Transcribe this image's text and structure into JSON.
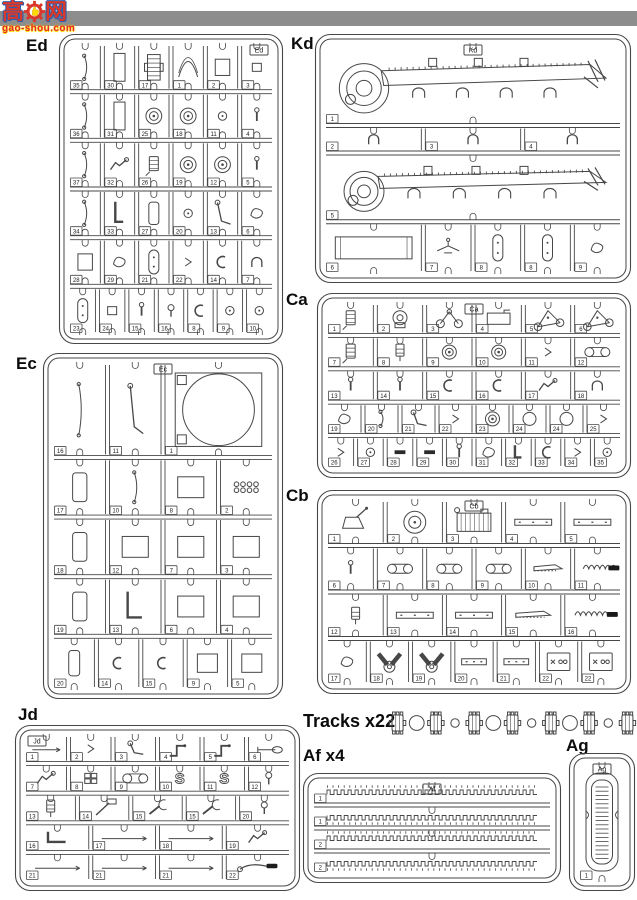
{
  "colors": {
    "topbar": "#8d8d8d",
    "line": "#474747",
    "logo_red": "#d8392b",
    "logo_blue": "#2b5fb0",
    "logo_yellow": "#ffd900"
  },
  "logo": {
    "char_left": "高",
    "char_right": "网",
    "domain": "gao-shou.com"
  },
  "tracks": {
    "label": "Tracks x22",
    "items": [
      "link",
      "big",
      "link",
      "small",
      "link",
      "big",
      "link",
      "small",
      "link",
      "big",
      "link",
      "small",
      "link"
    ]
  },
  "sprues": [
    {
      "id": "ed",
      "label": "Ed",
      "tag": "Ed",
      "tag_pos": "tr",
      "rows": [
        {
          "cells": [
            {
              "n": "35",
              "g": "rod"
            },
            {
              "n": "30",
              "g": "tallrect"
            },
            {
              "n": "17",
              "g": "grill"
            },
            {
              "n": "1",
              "g": "arc"
            },
            {
              "n": "2",
              "g": "rect"
            },
            {
              "n": "3",
              "g": "sq"
            }
          ]
        },
        {
          "cells": [
            {
              "n": "36",
              "g": "rod"
            },
            {
              "n": "31",
              "g": "tallrect"
            },
            {
              "n": "25",
              "g": "wheel"
            },
            {
              "n": "18",
              "g": "wheel"
            },
            {
              "n": "11",
              "g": "smallcircle"
            },
            {
              "n": "4",
              "g": "bolt"
            }
          ]
        },
        {
          "cells": [
            {
              "n": "37",
              "g": "rod"
            },
            {
              "n": "32",
              "g": "tool"
            },
            {
              "n": "26",
              "g": "cylinder"
            },
            {
              "n": "19",
              "g": "wheel"
            },
            {
              "n": "12",
              "g": "wheel"
            },
            {
              "n": "5",
              "g": "bolt"
            }
          ]
        },
        {
          "cells": [
            {
              "n": "34",
              "g": "rod"
            },
            {
              "n": "33",
              "g": "pipe"
            },
            {
              "n": "27",
              "g": "pad"
            },
            {
              "n": "20",
              "g": "smallcircle"
            },
            {
              "n": "13",
              "g": "lever"
            },
            {
              "n": "6",
              "g": "blob"
            }
          ]
        },
        {
          "cells": [
            {
              "n": "28",
              "g": "rect"
            },
            {
              "n": "29",
              "g": "blob"
            },
            {
              "n": "21",
              "g": "oval"
            },
            {
              "n": "22",
              "g": "tiny"
            },
            {
              "n": "14",
              "g": "clip"
            },
            {
              "n": "7",
              "g": "bracket"
            }
          ]
        },
        {
          "cells": [
            {
              "n": "23",
              "g": "oval"
            },
            {
              "n": "24",
              "g": "sq"
            },
            {
              "n": "15",
              "g": "bolt"
            },
            {
              "n": "16",
              "g": "bulb"
            },
            {
              "n": "8",
              "g": "clip"
            },
            {
              "n": "9",
              "g": "smallcircle"
            },
            {
              "n": "10",
              "g": "smallcircle"
            }
          ]
        }
      ]
    },
    {
      "id": "kd",
      "label": "Kd",
      "tag": "Kd",
      "tag_pos": "tc",
      "rows": [
        {
          "h": 1.5,
          "cells": [
            {
              "n": "1",
              "g": "fender"
            }
          ]
        },
        {
          "h": 0.5,
          "cells": [
            {
              "n": "2",
              "g": "bracket"
            },
            {
              "n": "3",
              "g": "bracket"
            },
            {
              "n": "4",
              "g": "bracket"
            }
          ]
        },
        {
          "h": 1.25,
          "cells": [
            {
              "n": "5",
              "g": "fender"
            }
          ]
        },
        {
          "h": 0.95,
          "cells": [
            {
              "n": "6",
              "g": "longrect",
              "s": 2
            },
            {
              "n": "7",
              "g": "plane"
            },
            {
              "n": "8",
              "g": "oval"
            },
            {
              "n": "8",
              "g": "oval"
            },
            {
              "n": "9",
              "g": "blob"
            }
          ]
        }
      ]
    },
    {
      "id": "ec",
      "label": "Ec",
      "tag": "Ec",
      "tag_pos": "tc",
      "rows": [
        {
          "h": 1.6,
          "cells": [
            {
              "n": "16",
              "g": "rod"
            },
            {
              "n": "11",
              "g": "lever"
            },
            {
              "n": "1",
              "g": "bigcircle",
              "s": 2
            }
          ]
        },
        {
          "h": 1,
          "cells": [
            {
              "n": "17",
              "g": "pad"
            },
            {
              "n": "10",
              "g": "rod"
            },
            {
              "n": "8",
              "g": "rect"
            },
            {
              "n": "2",
              "g": "grid8"
            }
          ]
        },
        {
          "h": 1,
          "cells": [
            {
              "n": "18",
              "g": "pad"
            },
            {
              "n": "12",
              "g": "rect"
            },
            {
              "n": "7",
              "g": "rect"
            },
            {
              "n": "3",
              "g": "rect"
            }
          ]
        },
        {
          "h": 1,
          "cells": [
            {
              "n": "19",
              "g": "pad"
            },
            {
              "n": "13",
              "g": "pipe"
            },
            {
              "n": "6",
              "g": "rect"
            },
            {
              "n": "4",
              "g": "rect"
            }
          ]
        },
        {
          "h": 0.9,
          "cells": [
            {
              "n": "20",
              "g": "pad"
            },
            {
              "n": "14",
              "g": "clip"
            },
            {
              "n": "15",
              "g": "clip"
            },
            {
              "n": "9",
              "g": "rect"
            },
            {
              "n": "5",
              "g": "rect"
            }
          ]
        }
      ]
    },
    {
      "id": "ca",
      "label": "Ca",
      "tag": "Ca",
      "tag_pos": "tc",
      "rows": [
        {
          "cells": [
            {
              "n": "1",
              "g": "cylinder"
            },
            {
              "n": "2",
              "g": "pump"
            },
            {
              "n": "3",
              "g": "axle"
            },
            {
              "n": "4",
              "g": "box"
            },
            {
              "n": "5",
              "g": "arm"
            },
            {
              "n": "6",
              "g": "arm"
            }
          ]
        },
        {
          "cells": [
            {
              "n": "7",
              "g": "cylinder"
            },
            {
              "n": "8",
              "g": "jack"
            },
            {
              "n": "9",
              "g": "wheel"
            },
            {
              "n": "10",
              "g": "wheel"
            },
            {
              "n": "11",
              "g": "tiny"
            },
            {
              "n": "12",
              "g": "links"
            }
          ]
        },
        {
          "cells": [
            {
              "n": "13",
              "g": "bolt"
            },
            {
              "n": "14",
              "g": "bolt"
            },
            {
              "n": "15",
              "g": "clip"
            },
            {
              "n": "16",
              "g": "clip"
            },
            {
              "n": "17",
              "g": "tool"
            },
            {
              "n": "18",
              "g": "bracket"
            }
          ]
        },
        {
          "cells": [
            {
              "n": "19",
              "g": "blob"
            },
            {
              "n": "20",
              "g": "rod"
            },
            {
              "n": "21",
              "g": "lever"
            },
            {
              "n": "22",
              "g": "tiny"
            },
            {
              "n": "23",
              "g": "wheel"
            },
            {
              "n": "24",
              "g": "circle"
            },
            {
              "n": "24",
              "g": "circle"
            },
            {
              "n": "25",
              "g": "tiny"
            }
          ]
        },
        {
          "cells": [
            {
              "n": "26",
              "g": "tiny"
            },
            {
              "n": "27",
              "g": "smallcircle"
            },
            {
              "n": "28",
              "g": "bar"
            },
            {
              "n": "29",
              "g": "bar"
            },
            {
              "n": "30",
              "g": "bolt"
            },
            {
              "n": "31",
              "g": "blob"
            },
            {
              "n": "32",
              "g": "pipe"
            },
            {
              "n": "33",
              "g": "clip"
            },
            {
              "n": "34",
              "g": "tiny"
            },
            {
              "n": "35",
              "g": "smallcircle"
            }
          ]
        }
      ]
    },
    {
      "id": "cb",
      "label": "Cb",
      "tag": "Cb",
      "tag_pos": "tc",
      "rows": [
        {
          "cells": [
            {
              "n": "1",
              "g": "bucket"
            },
            {
              "n": "2",
              "g": "wheel"
            },
            {
              "n": "3",
              "g": "engine"
            },
            {
              "n": "4",
              "g": "plate"
            },
            {
              "n": "5",
              "g": "plate"
            }
          ]
        },
        {
          "cells": [
            {
              "n": "6",
              "g": "bolt"
            },
            {
              "n": "7",
              "g": "links"
            },
            {
              "n": "8",
              "g": "links"
            },
            {
              "n": "9",
              "g": "links"
            },
            {
              "n": "10",
              "g": "saw"
            },
            {
              "n": "11",
              "g": "blacksaw"
            }
          ]
        },
        {
          "cells": [
            {
              "n": "12",
              "g": "jack"
            },
            {
              "n": "13",
              "g": "plate"
            },
            {
              "n": "14",
              "g": "plate"
            },
            {
              "n": "15",
              "g": "saw"
            },
            {
              "n": "16",
              "g": "blacksaw"
            }
          ]
        },
        {
          "cells": [
            {
              "n": "17",
              "g": "blob"
            },
            {
              "n": "18",
              "g": "vee"
            },
            {
              "n": "19",
              "g": "vee"
            },
            {
              "n": "20",
              "g": "plate"
            },
            {
              "n": "21",
              "g": "plate"
            },
            {
              "n": "22",
              "g": "x3"
            },
            {
              "n": "22",
              "g": "x3"
            }
          ]
        }
      ]
    },
    {
      "id": "jd",
      "label": "Jd",
      "tag": "Jd",
      "tag_pos": "tl",
      "rows": [
        {
          "cells": [
            {
              "n": "1",
              "g": "lrod"
            },
            {
              "n": "2",
              "g": "tiny"
            },
            {
              "n": "3",
              "g": "lever"
            },
            {
              "n": "4",
              "g": "crank"
            },
            {
              "n": "5",
              "g": "crank"
            },
            {
              "n": "6",
              "g": "shovel"
            }
          ]
        },
        {
          "cells": [
            {
              "n": "7",
              "g": "tool"
            },
            {
              "n": "8",
              "g": "grid4"
            },
            {
              "n": "9",
              "g": "links"
            },
            {
              "n": "10",
              "g": "s"
            },
            {
              "n": "11",
              "g": "s"
            },
            {
              "n": "12",
              "g": "bulb"
            }
          ]
        },
        {
          "cells": [
            {
              "n": "13",
              "g": "jack"
            },
            {
              "n": "14",
              "g": "hammer"
            },
            {
              "n": "15",
              "g": "wrench"
            },
            {
              "n": "15",
              "g": "wrench"
            },
            {
              "n": "20",
              "g": "bulb"
            }
          ]
        },
        {
          "cells": [
            {
              "n": "16",
              "g": "pipe"
            },
            {
              "n": "17",
              "g": "lrod"
            },
            {
              "n": "18",
              "g": "lrod"
            },
            {
              "n": "19",
              "g": "tool"
            }
          ]
        },
        {
          "cells": [
            {
              "n": "21",
              "g": "lrod"
            },
            {
              "n": "21",
              "g": "lrod"
            },
            {
              "n": "21",
              "g": "lrod"
            },
            {
              "n": "22",
              "g": "cable"
            }
          ]
        }
      ]
    },
    {
      "id": "af",
      "label": "Af x4",
      "tag": "Af",
      "tag_pos": "tc",
      "rows": [
        {
          "cells": [
            {
              "n": "1",
              "g": "comb"
            }
          ]
        },
        {
          "cells": [
            {
              "n": "1",
              "g": "combd"
            }
          ]
        },
        {
          "cells": [
            {
              "n": "2",
              "g": "comb"
            }
          ]
        },
        {
          "cells": [
            {
              "n": "2",
              "g": "combd"
            }
          ]
        }
      ]
    },
    {
      "id": "ag",
      "label": "Ag",
      "tag": "Ag",
      "tag_pos": "tc",
      "rows": [
        {
          "cells": [
            {
              "n": "1",
              "g": "ladder"
            }
          ]
        }
      ]
    }
  ]
}
